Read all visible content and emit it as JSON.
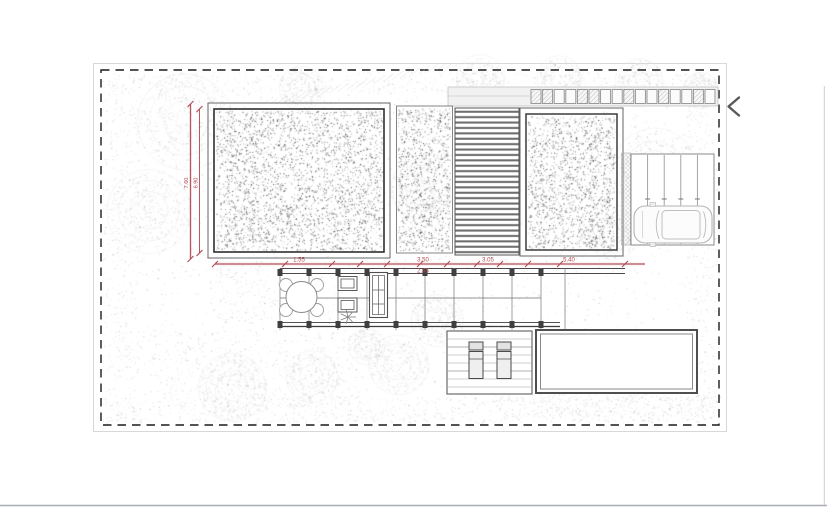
{
  "view": {
    "type": "architectural-site-plan",
    "icons": {
      "prev_arrow": "chevron-left"
    }
  },
  "colors": {
    "dimension_red": "#b0474e",
    "boundary_black": "#1a1a1a",
    "deck_stripe_gray": "#6f6f6f",
    "page_divider_gray": "#a7adb0"
  },
  "dimensions": {
    "vertical": [
      {
        "label": "7.60"
      },
      {
        "label": "6.90"
      }
    ],
    "horizontal": [
      {
        "label": "1.55"
      },
      {
        "label": "3.50"
      },
      {
        "label": "3.05"
      },
      {
        "label": "5.40"
      }
    ],
    "horizontal_below": [
      {
        "label": "2.45"
      }
    ]
  }
}
